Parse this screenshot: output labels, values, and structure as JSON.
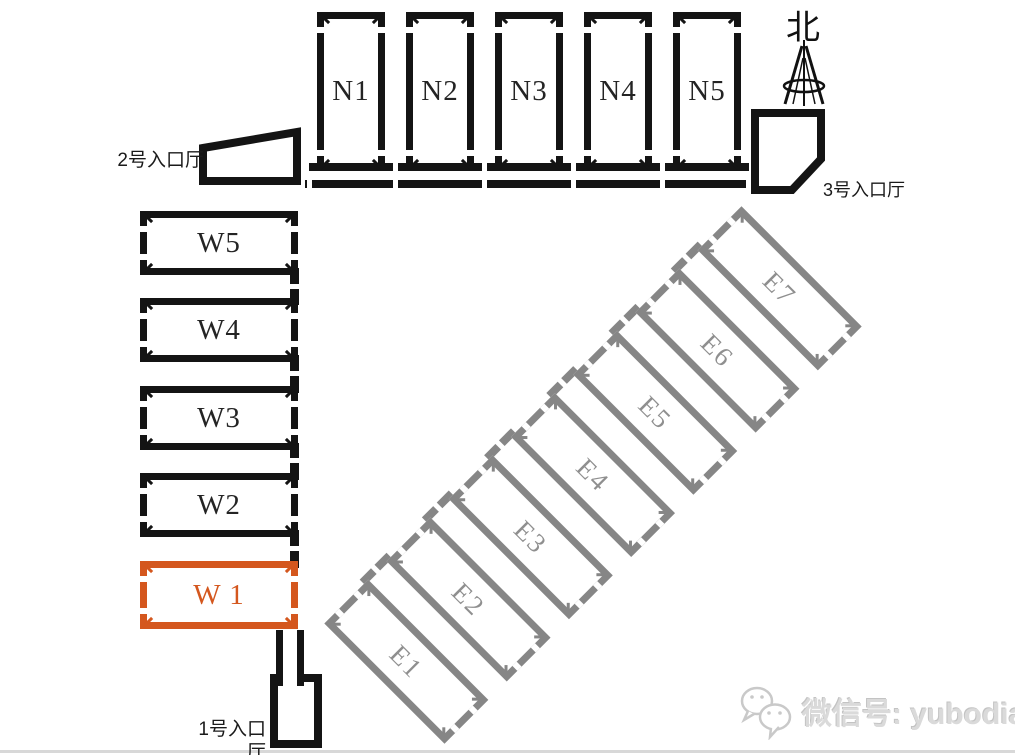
{
  "compass": {
    "label": "北",
    "icon": "north-tower-icon"
  },
  "entrances": [
    {
      "label": "1号入口厅"
    },
    {
      "label": "2号入口厅"
    },
    {
      "label": "3号入口厅"
    }
  ],
  "halls": {
    "north": [
      "N1",
      "N2",
      "N3",
      "N4",
      "N5"
    ],
    "west": [
      "W5",
      "W4",
      "W3",
      "W2",
      "W 1"
    ],
    "east": [
      "E1",
      "E2",
      "E3",
      "E4",
      "E5",
      "E6",
      "E7"
    ],
    "highlighted_hall": "W 1"
  },
  "watermark": {
    "icon": "wechat-icon",
    "text": "微信号: yubodia"
  },
  "colors": {
    "wall_black": "#141414",
    "wall_gray": "#868686",
    "highlight_orange": "#d4571e",
    "watermark_gray": "#dadada"
  }
}
